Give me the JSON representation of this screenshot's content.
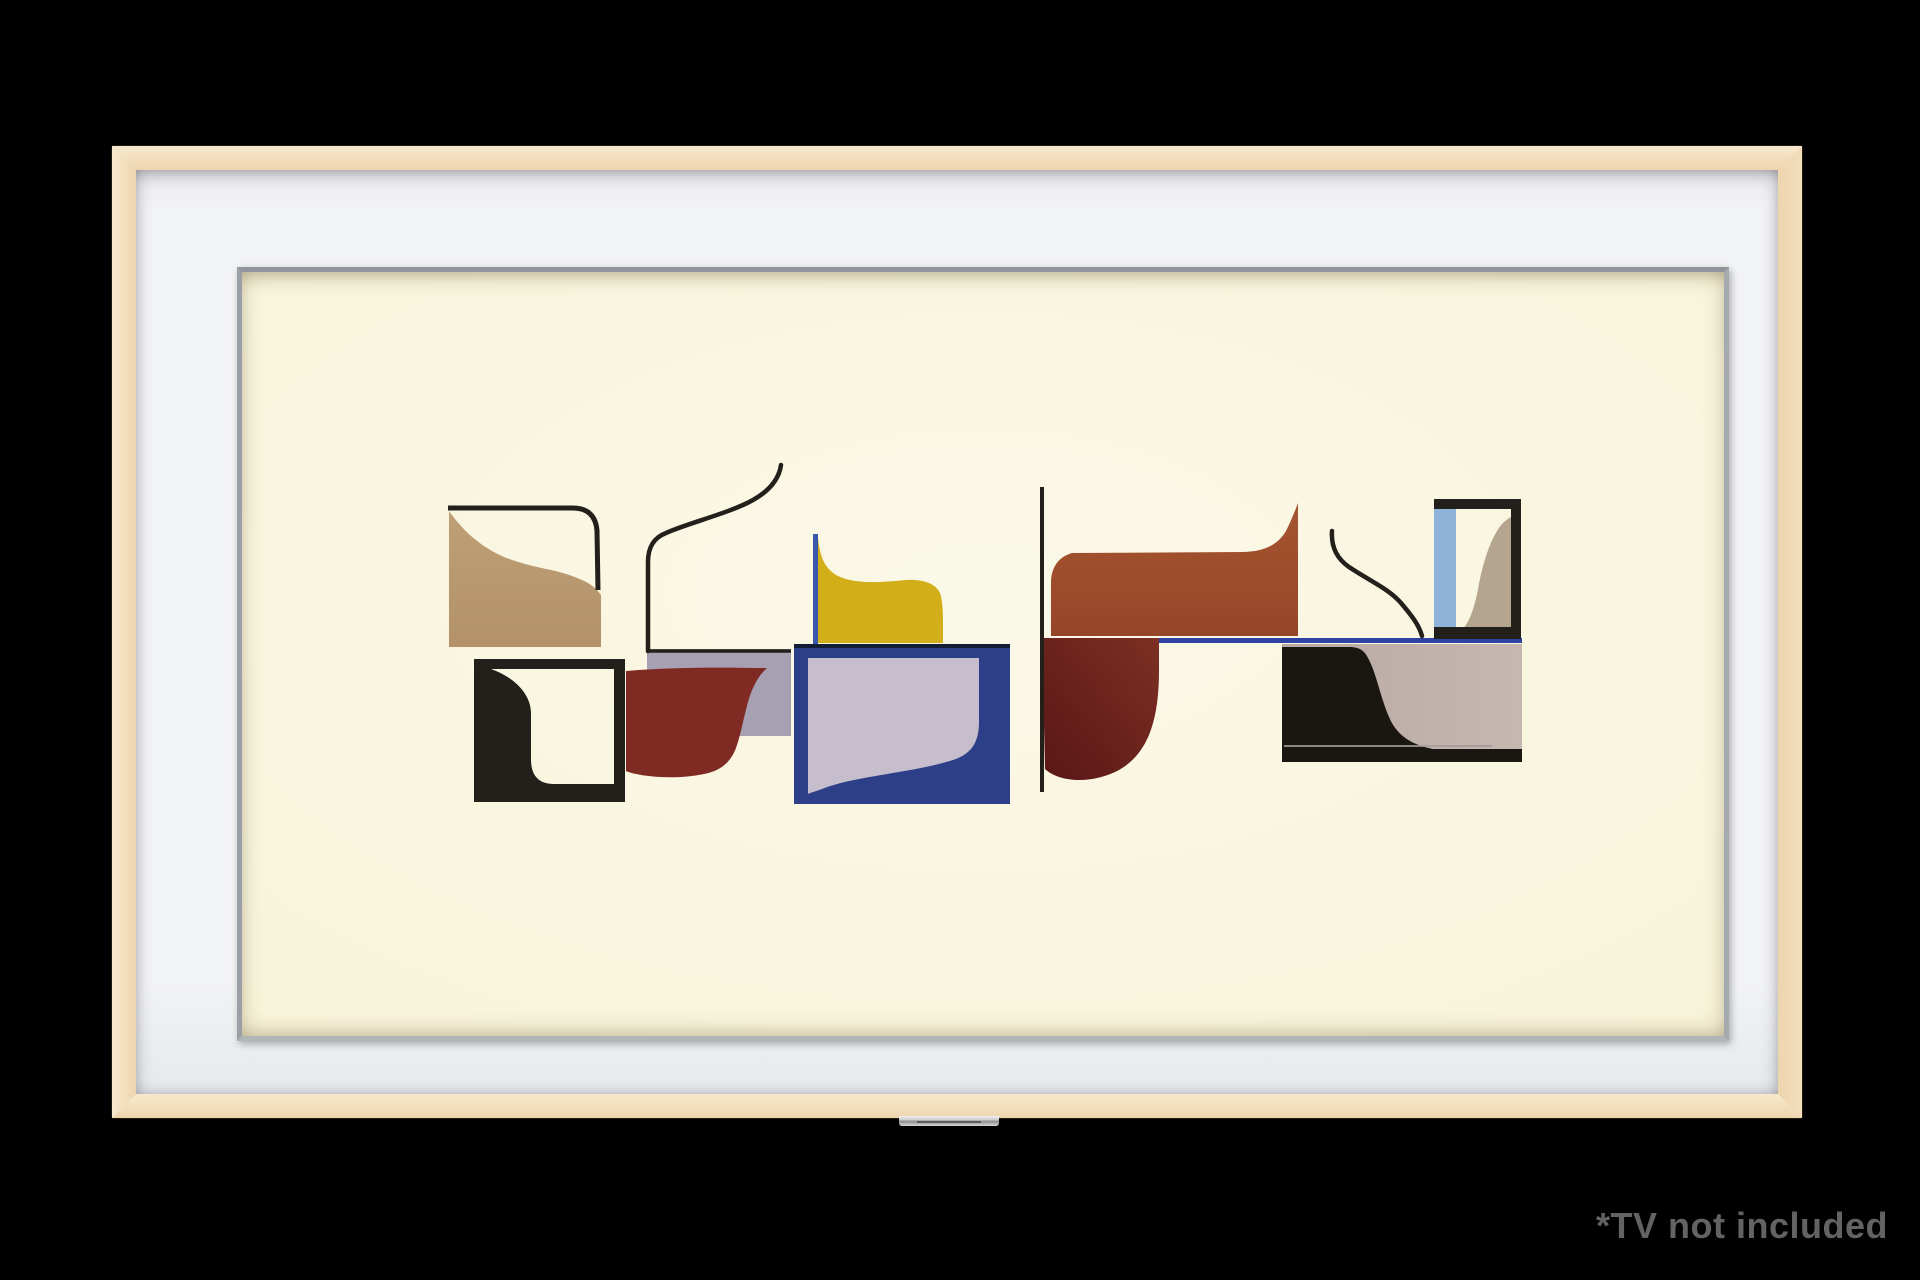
{
  "disclaimer": {
    "text": "*TV not included"
  },
  "colors": {
    "background": "#000000",
    "wood": "#f3debc",
    "woodLight": "#f8e9cf",
    "woodDark": "#eed5ae",
    "matte": "#f2f3f5",
    "bezel": "#9aa0a5",
    "canvas": "#f8f4da",
    "disclaimerColor": "#636365",
    "ink": "#23201b",
    "ink2": "#1a1713",
    "tan": "#b3926a",
    "tanLight": "#bf9f76",
    "lavA": "#a7a0b2",
    "lavB": "#c7becd",
    "navy": "#2c3f88",
    "navyDark": "#141d36",
    "blueStripe": "#3a57ae",
    "blueLine": "#2e43a4",
    "skyblue": "#8fb2d8",
    "yellow": "#d2af19",
    "maroonA": "#7f2b24",
    "maroonDeep1": "#7c2f24",
    "maroonDeep2": "#591715",
    "rustTop": "#a65530",
    "rustBottom": "#964628",
    "taupe": "#b5a48e",
    "grayR1": "#b9a9a4",
    "grayR2": "#c6b7b1",
    "hairline": "#a59b95"
  }
}
